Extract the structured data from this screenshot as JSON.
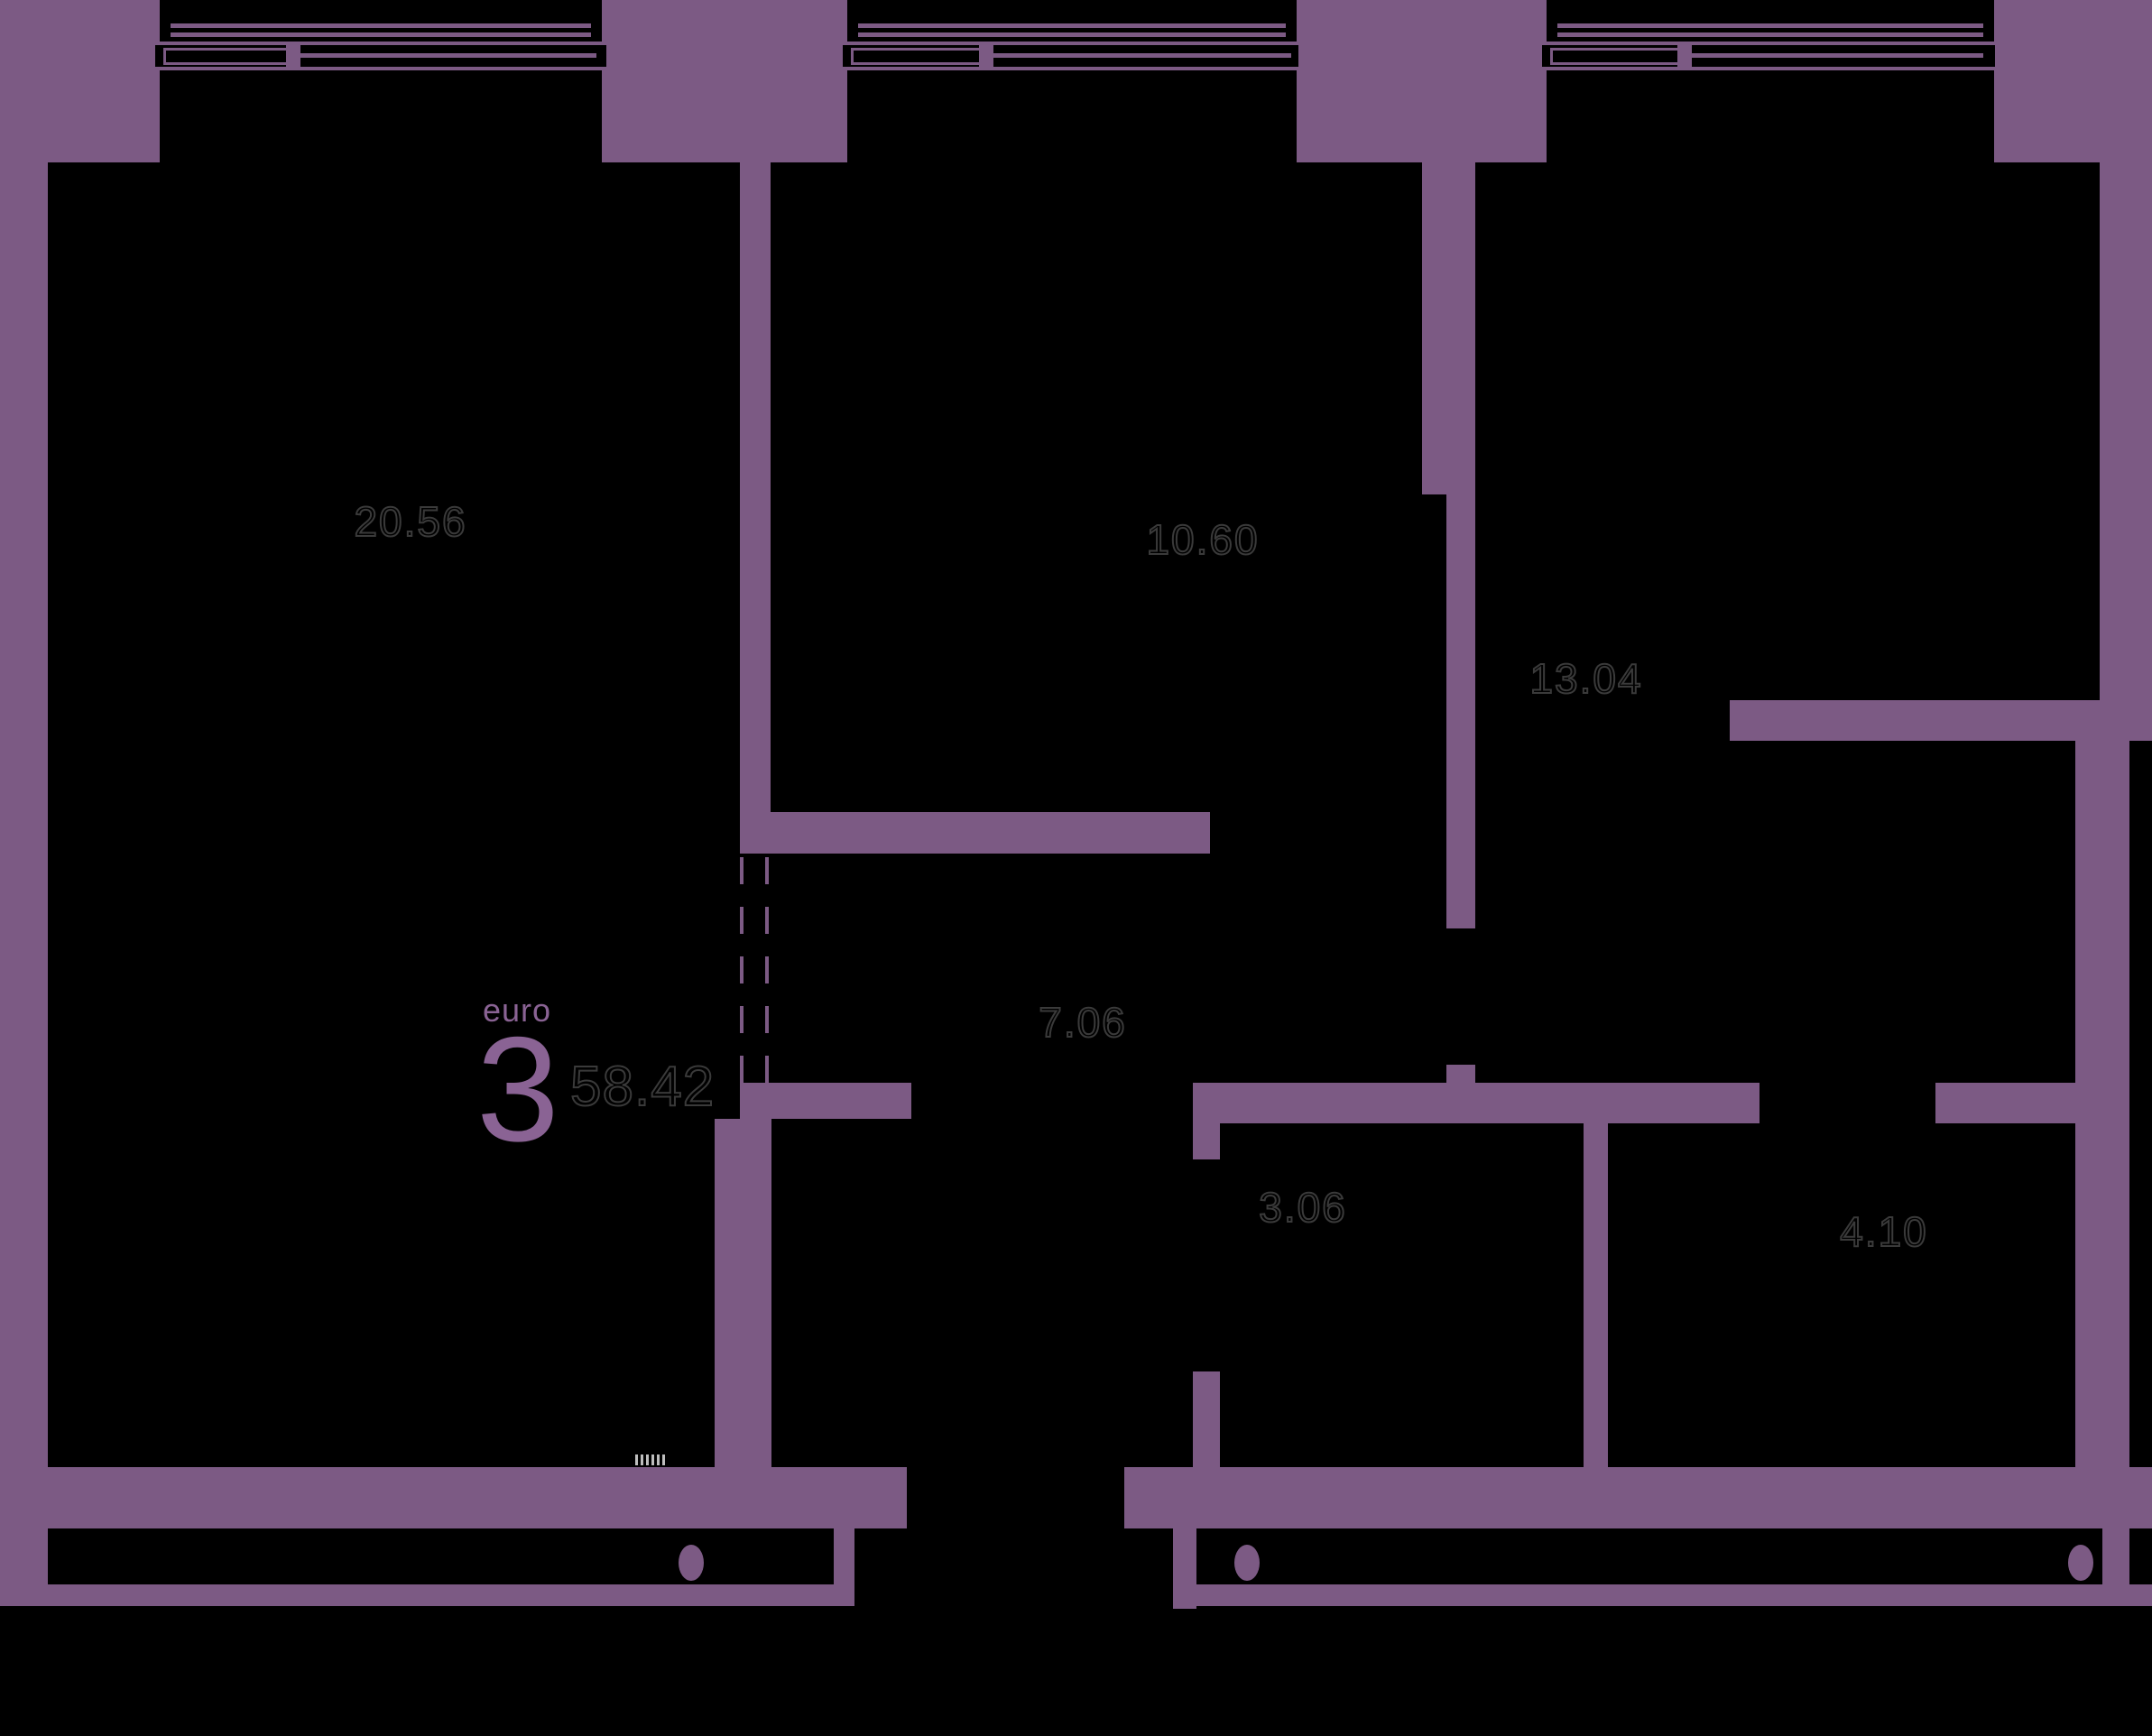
{
  "unit": {
    "type_label": "euro",
    "rooms_count": "3",
    "total_area": "58.42"
  },
  "rooms": [
    {
      "name": "living-room",
      "area": "20.56"
    },
    {
      "name": "kitchen",
      "area": "10.60"
    },
    {
      "name": "bedroom",
      "area": "13.04"
    },
    {
      "name": "hallway",
      "area": "7.06"
    },
    {
      "name": "bathroom",
      "area": "3.06"
    },
    {
      "name": "storage-room",
      "area": "4.10"
    }
  ],
  "colors": {
    "background": "#000000",
    "wall": "#7c5a84",
    "accent_text": "#8a6394",
    "room_label_stroke": "#3a3a3a",
    "micro_mark": "#e0e0e0"
  }
}
